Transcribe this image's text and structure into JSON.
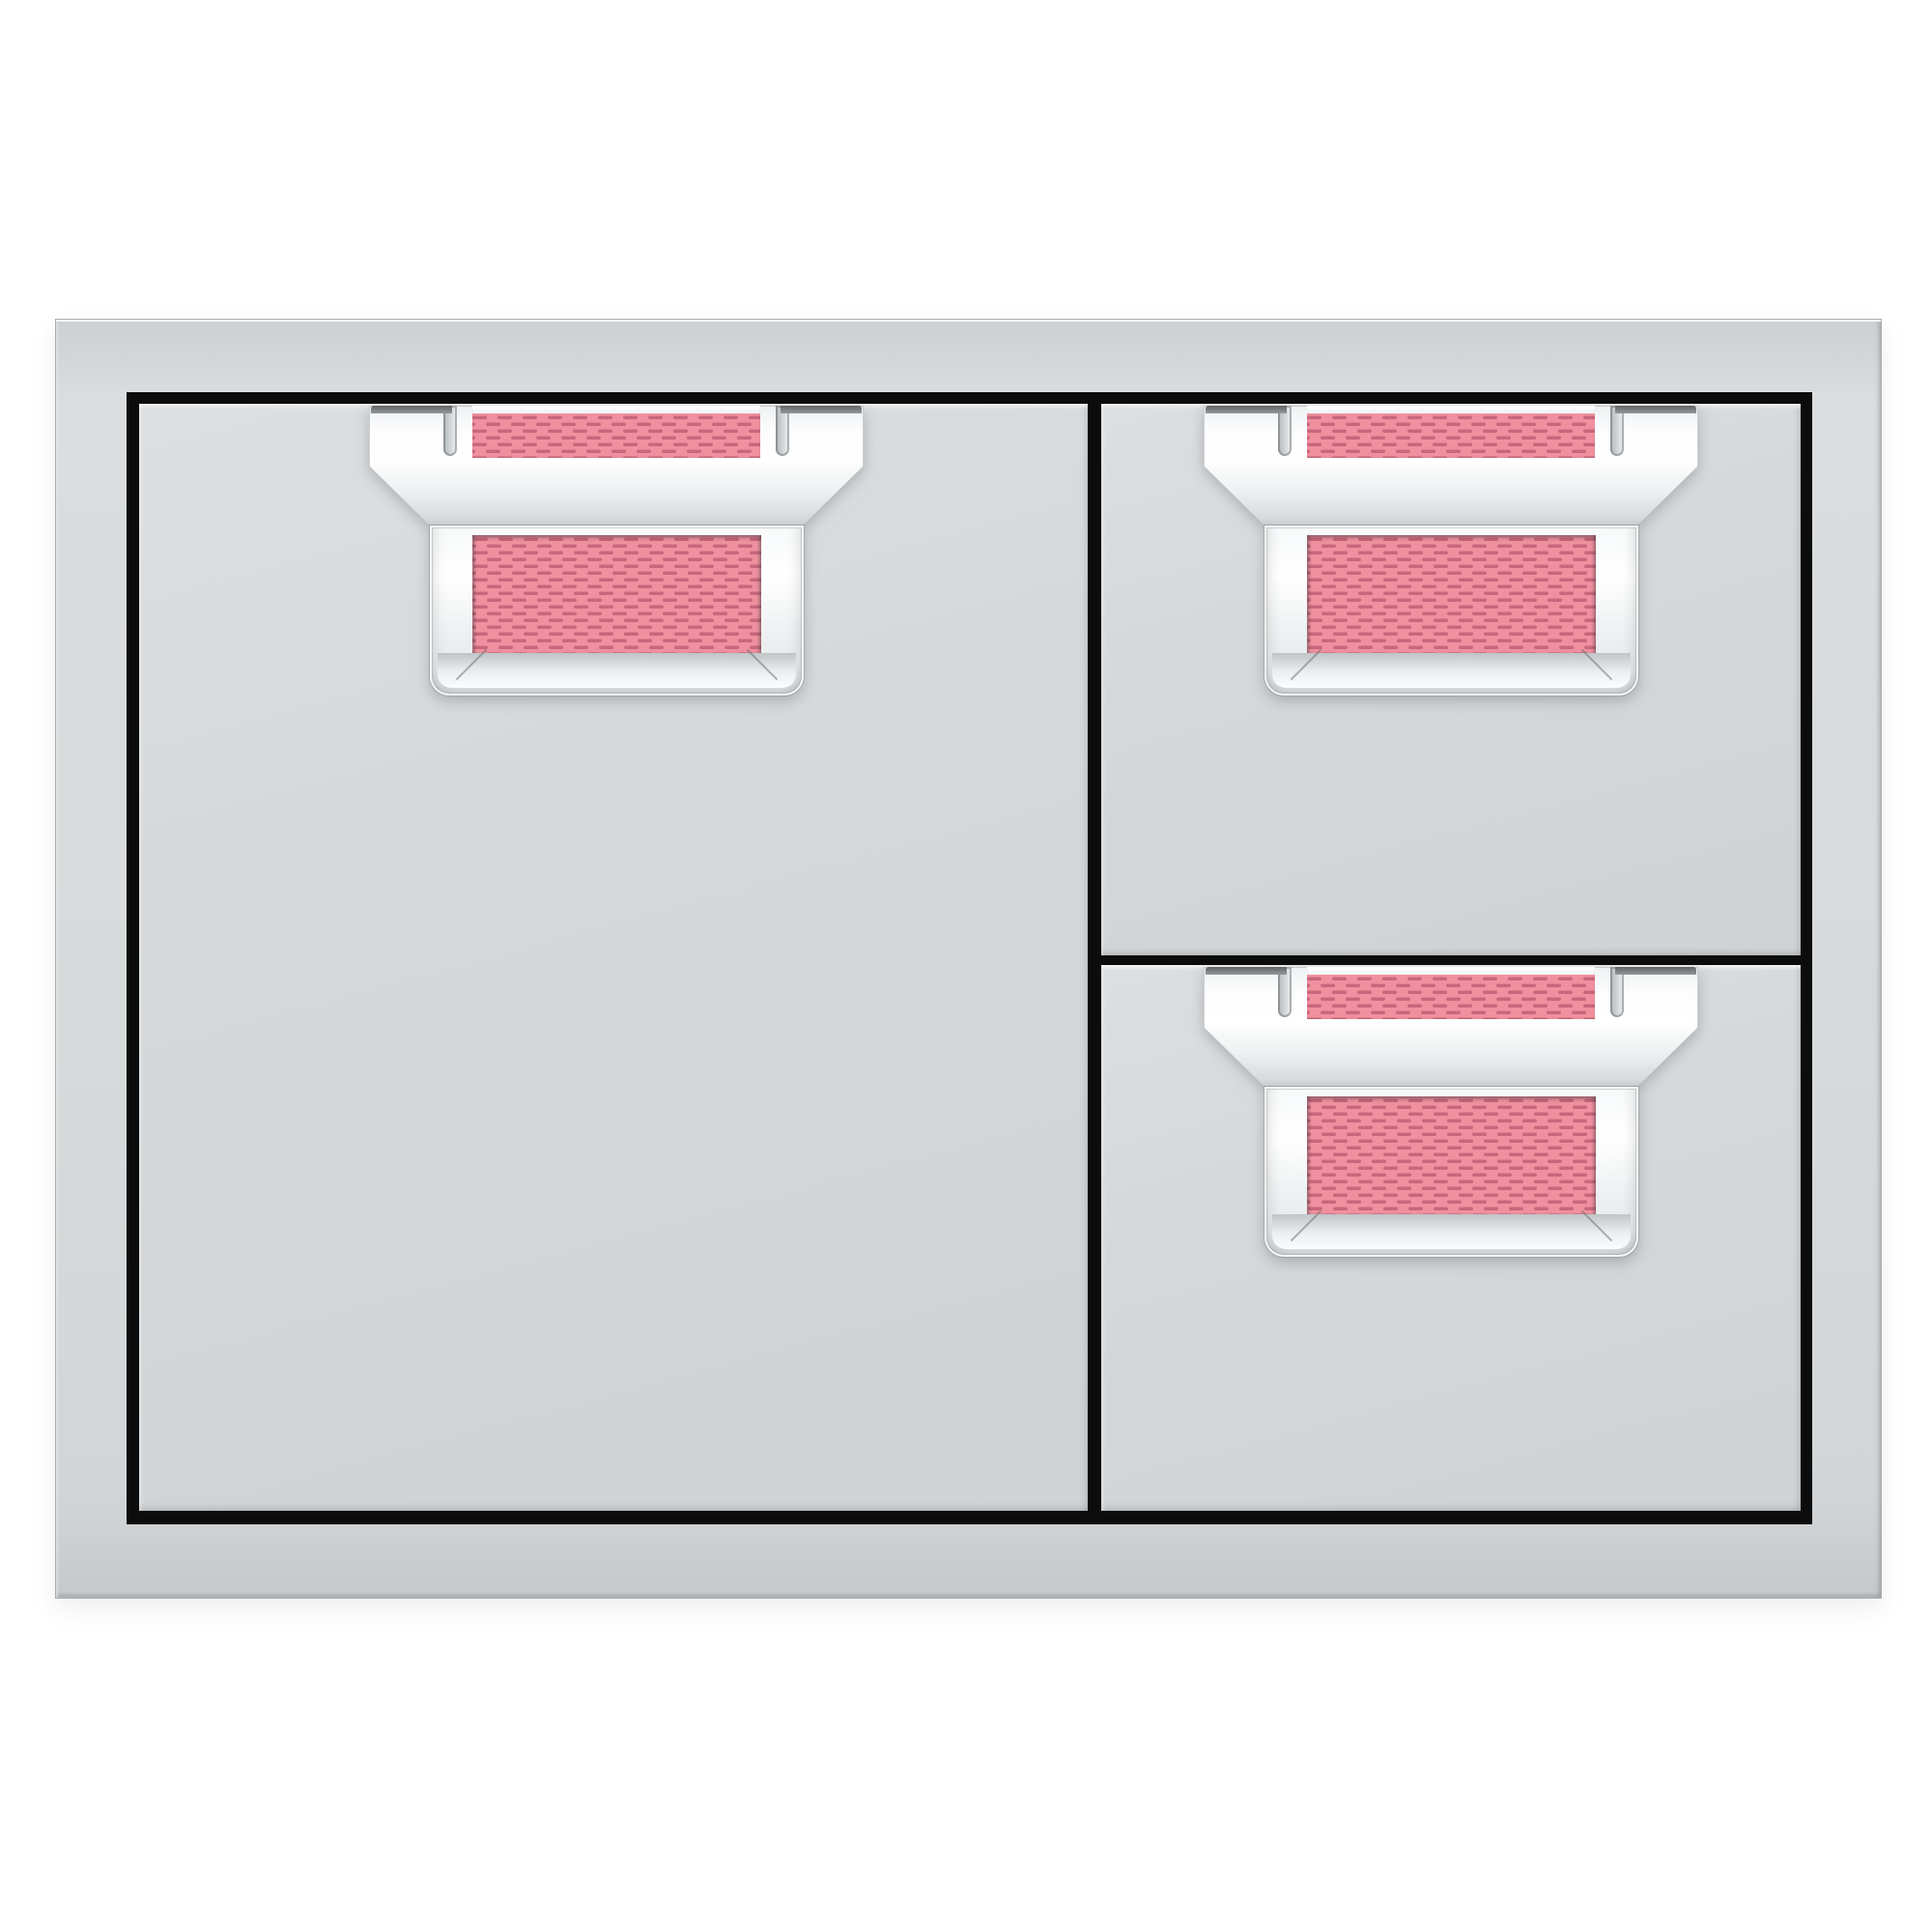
{
  "colors": {
    "background": "#ffffff",
    "frame": "#d7dadb",
    "frame_edge": "#a9adb0",
    "panel": "#d5d8da",
    "gap": "#0c0c0d",
    "hook_dark": "#5f6366",
    "chrome_light": "#f7f9fa",
    "chrome_dark": "#c7cbce",
    "accent": "#f0909f",
    "accent_dash": "#c8677c"
  },
  "parts": {
    "unit": "stainless steel door and double drawer combo",
    "frame": "stainless steel surround frame",
    "door": "left access door",
    "drawer_top": "upper right drawer",
    "drawer_bottom": "lower right drawer",
    "door_handle": "door handle with accent insert",
    "drawer_top_handle": "upper drawer handle with accent insert",
    "drawer_bottom_handle": "lower drawer handle with accent insert"
  }
}
